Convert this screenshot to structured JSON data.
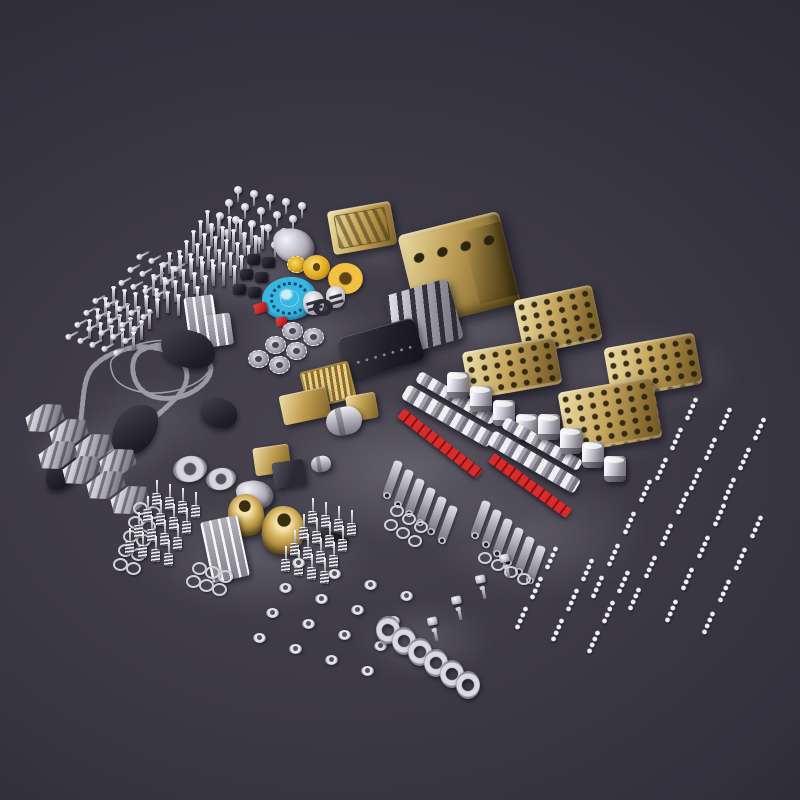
{
  "meta": {
    "description": "Flat-lay photo of a metal V8 model engine kit: hundreds of silver screws, valves and springs, a gold engine block with four cylinder heads, gold pulleys, a blue timing gear, red rod seals, piston and connecting-rod assemblies, timing chains, engine mounts and a crankshaft on a dark glossy surface."
  },
  "scene": {
    "width": 800,
    "height": 800,
    "palette": {
      "chain": "#9b98a6",
      "gold": "#c9a551",
      "silver": "#d7d5de",
      "blue": "#38b6e0",
      "red": "#c61f1f",
      "background": "#3d3a46"
    },
    "parts": [
      {
        "name": "surface-reflection",
        "kind": "k-glow",
        "x": 150,
        "y": 225,
        "w": 200,
        "h": 95,
        "op": 0.5
      },
      {
        "name": "surface-reflection",
        "kind": "k-glow",
        "x": 385,
        "y": 275,
        "w": 180,
        "h": 95,
        "op": 0.55
      },
      {
        "name": "surface-reflection",
        "kind": "k-glow",
        "x": 535,
        "y": 325,
        "w": 210,
        "h": 95,
        "op": 0.5
      },
      {
        "name": "surface-reflection",
        "kind": "k-glow",
        "x": 235,
        "y": 295,
        "w": 150,
        "h": 80,
        "op": 0.45
      },
      {
        "name": "surface-reflection",
        "kind": "k-glow",
        "x": 270,
        "y": 395,
        "w": 280,
        "h": 150,
        "op": 0.6
      },
      {
        "name": "surface-reflection",
        "kind": "k-glow",
        "x": 15,
        "y": 415,
        "w": 160,
        "h": 80,
        "op": 0.45
      },
      {
        "name": "surface-reflection",
        "kind": "k-glow",
        "x": 75,
        "y": 375,
        "w": 150,
        "h": 90,
        "op": 0.35
      },
      {
        "name": "surface-reflection",
        "kind": "k-glow",
        "x": 135,
        "y": 495,
        "w": 240,
        "h": 120,
        "op": 0.5
      },
      {
        "name": "surface-reflection",
        "kind": "k-glow",
        "x": 420,
        "y": 470,
        "w": 230,
        "h": 130,
        "op": 0.5
      },
      {
        "name": "surface-reflection",
        "kind": "k-glow",
        "x": 355,
        "y": 600,
        "w": 140,
        "h": 80,
        "op": 0.45
      },
      {
        "name": "surface-reflection",
        "kind": "k-glow",
        "x": 545,
        "y": 395,
        "w": 140,
        "h": 70,
        "op": 0.45
      },
      {
        "name": "surface-reflection",
        "kind": "k-glow",
        "x": 325,
        "y": 225,
        "w": 100,
        "h": 50,
        "op": 0.4
      },
      {
        "name": "bolt-grid",
        "kind": "k-screw",
        "x": 234,
        "y": 186,
        "w": 8,
        "h": 16,
        "repeat": {
          "cols": 5,
          "rows": 4,
          "dx": 16,
          "dy": 4,
          "rdx": -9,
          "rdy": 13
        }
      },
      {
        "name": "valve-stem-grid",
        "kind": "k-pin",
        "x": 206,
        "y": 212,
        "w": 3,
        "h": 22,
        "repeat": {
          "cols": 6,
          "rows": 5,
          "dx": 11,
          "dy": 3,
          "rdx": -7,
          "rdy": 10
        }
      },
      {
        "name": "valve-stem-grid",
        "kind": "k-pin",
        "x": 168,
        "y": 254,
        "w": 3,
        "h": 20,
        "repeat": {
          "cols": 5,
          "rows": 4,
          "dx": 11,
          "dy": 3,
          "rdx": -8,
          "rdy": 11
        }
      },
      {
        "name": "screw-row",
        "kind": "k-layscrew",
        "x": 136,
        "y": 252,
        "w": 14,
        "h": 6,
        "rot": -28,
        "repeat": {
          "cols": 4,
          "rows": 3,
          "dx": 12,
          "dy": 4,
          "rdx": -9,
          "rdy": 13
        }
      },
      {
        "name": "valve-stem-grid",
        "kind": "k-pin",
        "x": 112,
        "y": 288,
        "w": 3,
        "h": 18,
        "repeat": {
          "cols": 5,
          "rows": 4,
          "dx": 11,
          "dy": 3,
          "rdx": -8,
          "rdy": 11
        }
      },
      {
        "name": "screw-row",
        "kind": "k-layscrew",
        "x": 92,
        "y": 296,
        "w": 14,
        "h": 6,
        "rot": -28,
        "repeat": {
          "cols": 5,
          "rows": 4,
          "dx": 12,
          "dy": 4,
          "rdx": -9,
          "rdy": 12
        }
      },
      {
        "name": "rocker-stand",
        "kind": "k-rack-silver",
        "x": 186,
        "y": 296,
        "w": 30,
        "h": 42,
        "rot": -8
      },
      {
        "name": "rocker-stand",
        "kind": "k-rack-silver",
        "x": 206,
        "y": 314,
        "w": 26,
        "h": 32,
        "rot": -8
      },
      {
        "name": "valve-cover-gold",
        "kind": "k-cover-gold",
        "x": 330,
        "y": 206,
        "w": 64,
        "h": 44,
        "rot": -10
      },
      {
        "name": "timing-bracket",
        "kind": "k-bracket-ornate",
        "x": 274,
        "y": 228,
        "w": 40,
        "h": 36,
        "rot": -6
      },
      {
        "name": "rubber-grommet",
        "kind": "k-grommet-dark",
        "x": 247,
        "y": 254,
        "w": 13,
        "h": 11,
        "repeat": {
          "cols": 2,
          "rows": 3,
          "dx": 15,
          "dy": 3,
          "rdx": -7,
          "rdy": 15
        }
      },
      {
        "name": "idler-gear-gold",
        "kind": "k-gear-gold",
        "x": 287,
        "y": 256,
        "w": 17,
        "h": 15
      },
      {
        "name": "pulley-gold",
        "kind": "k-disc-gold",
        "x": 303,
        "y": 255,
        "w": 27,
        "h": 25
      },
      {
        "name": "pulley-gold-large",
        "kind": "k-torus-gold",
        "x": 328,
        "y": 263,
        "w": 35,
        "h": 31
      },
      {
        "name": "timing-gear-blue",
        "kind": "k-blue-gear",
        "x": 262,
        "y": 277,
        "w": 55,
        "h": 43,
        "rot": -6
      },
      {
        "name": "seal-red",
        "kind": "k-red-chip",
        "x": 254,
        "y": 303,
        "w": 13,
        "h": 10,
        "rot": -15
      },
      {
        "name": "seal-red",
        "kind": "k-red-chip",
        "x": 276,
        "y": 317,
        "w": 11,
        "h": 9,
        "rot": -12
      },
      {
        "name": "piston-cap",
        "kind": "k-cap-silver",
        "x": 303,
        "y": 291,
        "w": 21,
        "h": 24
      },
      {
        "name": "piston-cap",
        "kind": "k-cap-silver",
        "x": 326,
        "y": 286,
        "w": 19,
        "h": 22
      },
      {
        "name": "grommet-ring-dark",
        "kind": "k-ring-dark",
        "x": 313,
        "y": 299,
        "w": 20,
        "h": 17
      },
      {
        "name": "sprocket",
        "kind": "k-sprocket",
        "x": 282,
        "y": 322,
        "w": 19,
        "h": 16,
        "repeat": {
          "cols": 2,
          "rows": 3,
          "dx": 21,
          "dy": 6,
          "rdx": -17,
          "rdy": 14
        }
      },
      {
        "name": "engine-block-gold",
        "kind": "k-block-gold",
        "x": 407,
        "y": 222,
        "w": 104,
        "h": 94,
        "rot": -14
      },
      {
        "name": "cam-carrier-silver",
        "kind": "k-carrier-silver",
        "x": 391,
        "y": 286,
        "w": 66,
        "h": 62,
        "rot": -16
      },
      {
        "name": "cylinder-head-gold",
        "kind": "k-head-gold",
        "x": 518,
        "y": 292,
        "w": 80,
        "h": 56,
        "rot": -12
      },
      {
        "name": "cylinder-head-gold",
        "kind": "k-head-gold",
        "x": 607,
        "y": 340,
        "w": 92,
        "h": 52,
        "rot": -10
      },
      {
        "name": "cylinder-head-gold",
        "kind": "k-head-gold",
        "x": 465,
        "y": 344,
        "w": 94,
        "h": 48,
        "rot": -10
      },
      {
        "name": "cylinder-head-gold",
        "kind": "k-head-gold",
        "x": 562,
        "y": 384,
        "w": 96,
        "h": 62,
        "rot": -10
      },
      {
        "name": "valve-cover-black",
        "kind": "k-pan-dark",
        "x": 341,
        "y": 327,
        "w": 80,
        "h": 44,
        "rot": -16
      },
      {
        "name": "oil-cooler-gold",
        "kind": "k-fin-gold",
        "x": 303,
        "y": 366,
        "w": 46,
        "h": 34,
        "rot": -14
      },
      {
        "name": "motor-housing-gold",
        "kind": "k-box-gold",
        "x": 281,
        "y": 391,
        "w": 48,
        "h": 30,
        "rot": -12
      },
      {
        "name": "bracket-gold",
        "kind": "k-box-gold",
        "x": 347,
        "y": 394,
        "w": 30,
        "h": 26,
        "rot": -10
      },
      {
        "name": "starter-cylinder",
        "kind": "k-cyl-silver",
        "x": 326,
        "y": 407,
        "w": 36,
        "h": 28,
        "rot": -12
      },
      {
        "name": "carburetor-gold",
        "kind": "k-box-gold",
        "x": 254,
        "y": 446,
        "w": 36,
        "h": 28,
        "rot": -8
      },
      {
        "name": "control-box-dark",
        "kind": "k-box-dark",
        "x": 273,
        "y": 461,
        "w": 32,
        "h": 26,
        "rot": -8
      },
      {
        "name": "cylinder-small",
        "kind": "k-cyl-silver",
        "x": 311,
        "y": 456,
        "w": 20,
        "h": 16,
        "rot": -10
      },
      {
        "name": "chain-guide",
        "kind": "k-guide-dark",
        "x": 52,
        "y": 428,
        "w": 34,
        "h": 66,
        "rot": 28
      },
      {
        "name": "chain-guide",
        "kind": "k-guide-dark",
        "x": 115,
        "y": 402,
        "w": 40,
        "h": 56,
        "rot": 30
      },
      {
        "name": "chain-guide",
        "kind": "k-guide-dark",
        "x": 160,
        "y": 330,
        "w": 56,
        "h": 38,
        "rot": 24
      },
      {
        "name": "chain-guide",
        "kind": "k-guide-dark",
        "x": 200,
        "y": 398,
        "w": 38,
        "h": 30,
        "rot": 30
      },
      {
        "name": "tensioner-rail",
        "kind": "k-guide-dark",
        "x": 280,
        "y": 528,
        "w": 70,
        "h": 10,
        "rot": 12,
        "color": "#9d9aa8"
      },
      {
        "name": "engine-mount",
        "kind": "k-bracket-silver",
        "x": 26,
        "y": 404,
        "w": 38,
        "h": 28,
        "rot": -14,
        "repeat": {
          "cols": 4,
          "rows": 2,
          "dx": 24,
          "dy": 15,
          "rdx": 13,
          "rdy": 37
        }
      },
      {
        "name": "water-pump-flange",
        "kind": "k-ring-silver",
        "x": 173,
        "y": 456,
        "w": 34,
        "h": 26,
        "rot": -10
      },
      {
        "name": "water-pump-flange",
        "kind": "k-ring-silver",
        "x": 206,
        "y": 468,
        "w": 30,
        "h": 22,
        "rot": -10
      },
      {
        "name": "pump-bracket",
        "kind": "k-bracket-ornate",
        "x": 237,
        "y": 480,
        "w": 36,
        "h": 30,
        "rot": -12
      },
      {
        "name": "bearing-shell-gold",
        "kind": "k-shell-gold",
        "x": 228,
        "y": 494,
        "w": 36,
        "h": 42,
        "rot": -8
      },
      {
        "name": "bearing-shell-gold",
        "kind": "k-shell-gold",
        "x": 262,
        "y": 506,
        "w": 42,
        "h": 48,
        "rot": 6
      },
      {
        "name": "oil-pump-rack",
        "kind": "k-rack-silver",
        "x": 206,
        "y": 518,
        "w": 38,
        "h": 62,
        "rot": -12
      },
      {
        "name": "washer-row",
        "kind": "k-washer",
        "x": 133,
        "y": 502,
        "w": 11,
        "h": 9,
        "repeat": {
          "cols": 2,
          "rows": 5,
          "dx": 13,
          "dy": 4,
          "rdx": -5,
          "rdy": 14
        }
      },
      {
        "name": "valve-spring-grid",
        "kind": "k-spring",
        "x": 152,
        "y": 480,
        "w": 9,
        "h": 26,
        "repeat": {
          "cols": 4,
          "rows": 4,
          "dx": 13,
          "dy": 4,
          "rdx": -9,
          "rdy": 16
        }
      },
      {
        "name": "valve-spring-grid",
        "kind": "k-spring",
        "x": 308,
        "y": 498,
        "w": 9,
        "h": 26,
        "repeat": {
          "cols": 4,
          "rows": 4,
          "dx": 13,
          "dy": 4,
          "rdx": -9,
          "rdy": 16
        }
      },
      {
        "name": "washer-row",
        "kind": "k-washer",
        "x": 192,
        "y": 562,
        "w": 11,
        "h": 9,
        "repeat": {
          "cols": 3,
          "rows": 2,
          "dx": 13,
          "dy": 4,
          "rdx": -6,
          "rdy": 13
        }
      },
      {
        "name": "rocker-rail",
        "kind": "k-rail",
        "x": 412,
        "y": 392,
        "w": 88,
        "h": 12,
        "rot": 30
      },
      {
        "name": "cam-rail",
        "kind": "k-rail",
        "x": 398,
        "y": 408,
        "w": 100,
        "h": 16,
        "rot": 30
      },
      {
        "name": "rod-strip-red",
        "kind": "k-strip-red",
        "x": 390,
        "y": 438,
        "w": 100,
        "h": 11,
        "rot": 38
      },
      {
        "name": "piston",
        "kind": "k-piston",
        "x": 447,
        "y": 372,
        "w": 22,
        "h": 26,
        "repeat": {
          "cols": 4,
          "dx": 23,
          "dy": 14
        }
      },
      {
        "name": "connecting-rod",
        "kind": "k-rod",
        "x": 388,
        "y": 460,
        "w": 9,
        "h": 38,
        "rot": 20,
        "repeat": {
          "cols": 6,
          "dx": 11,
          "dy": 9
        }
      },
      {
        "name": "washer-row",
        "kind": "k-washer",
        "x": 390,
        "y": 505,
        "w": 10,
        "h": 8,
        "repeat": {
          "cols": 3,
          "rows": 2,
          "dx": 12,
          "dy": 8,
          "rdx": -6,
          "rdy": 14
        }
      },
      {
        "name": "rocker-rail",
        "kind": "k-rail",
        "x": 498,
        "y": 438,
        "w": 88,
        "h": 12,
        "rot": 30
      },
      {
        "name": "cam-rail",
        "kind": "k-rail",
        "x": 484,
        "y": 454,
        "w": 100,
        "h": 16,
        "rot": 30
      },
      {
        "name": "rod-strip-red",
        "kind": "k-strip-red",
        "x": 482,
        "y": 480,
        "w": 96,
        "h": 11,
        "rot": 36
      },
      {
        "name": "piston",
        "kind": "k-piston",
        "x": 538,
        "y": 414,
        "w": 22,
        "h": 26,
        "repeat": {
          "cols": 4,
          "dx": 22,
          "dy": 14
        }
      },
      {
        "name": "connecting-rod",
        "kind": "k-rod",
        "x": 476,
        "y": 500,
        "w": 9,
        "h": 38,
        "rot": 20,
        "repeat": {
          "cols": 6,
          "dx": 11,
          "dy": 9
        }
      },
      {
        "name": "washer-row",
        "kind": "k-washer",
        "x": 478,
        "y": 552,
        "w": 10,
        "h": 8,
        "repeat": {
          "cols": 4,
          "dx": 13,
          "dy": 7
        }
      },
      {
        "name": "bolt-string-field",
        "kind": "k-beads",
        "x": 688,
        "y": 396,
        "w": 7,
        "h": 26,
        "rot": 24,
        "repeat": {
          "cols": 3,
          "rows": 3,
          "dx": 34,
          "dy": 10,
          "rdx": -15,
          "rdy": 30
        }
      },
      {
        "name": "bolt-string-field",
        "kind": "k-beads",
        "x": 642,
        "y": 478,
        "w": 7,
        "h": 26,
        "rot": 24,
        "repeat": {
          "cols": 4,
          "rows": 4,
          "dx": 37,
          "dy": 12,
          "rdx": -16,
          "rdy": 32
        }
      },
      {
        "name": "bolt-string-field",
        "kind": "k-beads",
        "x": 548,
        "y": 545,
        "w": 7,
        "h": 26,
        "rot": 24,
        "repeat": {
          "cols": 3,
          "rows": 3,
          "dx": 36,
          "dy": 12,
          "rdx": -15,
          "rdy": 30
        }
      },
      {
        "name": "glow-plug",
        "kind": "k-plug",
        "x": 497,
        "y": 554,
        "w": 18,
        "h": 24,
        "rot": -12,
        "repeat": {
          "rows": 4,
          "rdx": -24,
          "rdy": 21
        }
      },
      {
        "name": "lifter-field",
        "kind": "k-tappet",
        "x": 292,
        "y": 558,
        "w": 13,
        "h": 10,
        "repeat": {
          "cols": 4,
          "rows": 4,
          "dx": 36,
          "dy": 11,
          "rdx": -13,
          "rdy": 25
        }
      },
      {
        "name": "crankshaft",
        "kind": "k-crank-ring",
        "x": 376,
        "y": 616,
        "w": 24,
        "h": 28,
        "repeat": {
          "cols": 6,
          "dx": 16,
          "dy": 11
        }
      }
    ]
  }
}
